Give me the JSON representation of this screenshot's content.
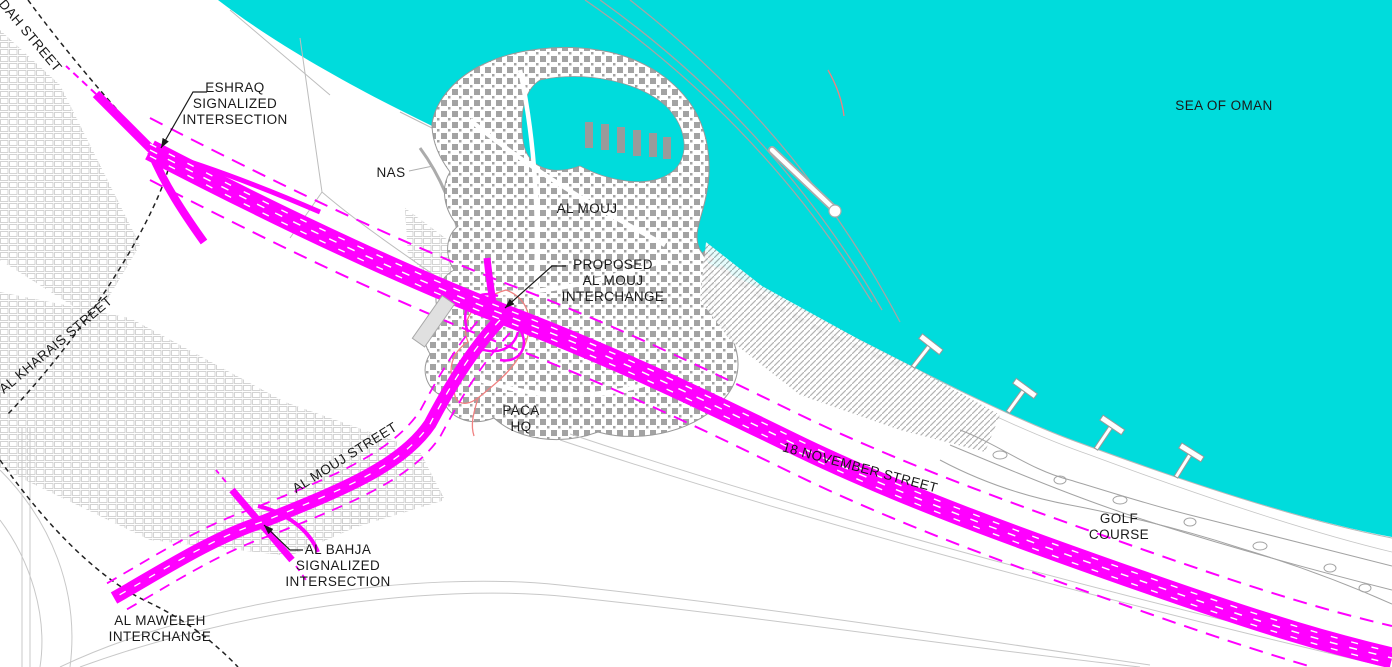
{
  "map": {
    "region_labels": {
      "sea": "SEA OF OMAN",
      "al_mouj": "AL MOUJ",
      "nas": "NAS",
      "golf_line1": "GOLF",
      "golf_line2": "COURSE",
      "paca_line1": "PACA",
      "paca_line2": "HQ"
    },
    "street_labels": {
      "dah": "DAH STREET",
      "al_kharais": "AL KHARAIS STREET",
      "al_mouj_street": "AL MOUJ STREET",
      "november_18": "18 NOVEMBER STREET"
    },
    "callouts": {
      "eshraq": {
        "line1": "ESHRAQ",
        "line2": "SIGNALIZED",
        "line3": "INTERSECTION"
      },
      "proposed_al_mouj": {
        "line1": "PROPOSED",
        "line2": "AL MOUJ",
        "line3": "INTERCHANGE"
      },
      "al_bahja": {
        "line1": "AL BAHJA",
        "line2": "SIGNALIZED",
        "line3": "INTERSECTION"
      },
      "al_maweleh": {
        "line1": "AL MAWELEH",
        "line2": "INTERCHANGE"
      }
    },
    "colors": {
      "sea": "#00DCDC",
      "proposed_road": "#FF00FF",
      "study_boundary": "#F08080",
      "existing_cad": "#9C9C9C",
      "label_text": "#1A1A1A"
    }
  }
}
